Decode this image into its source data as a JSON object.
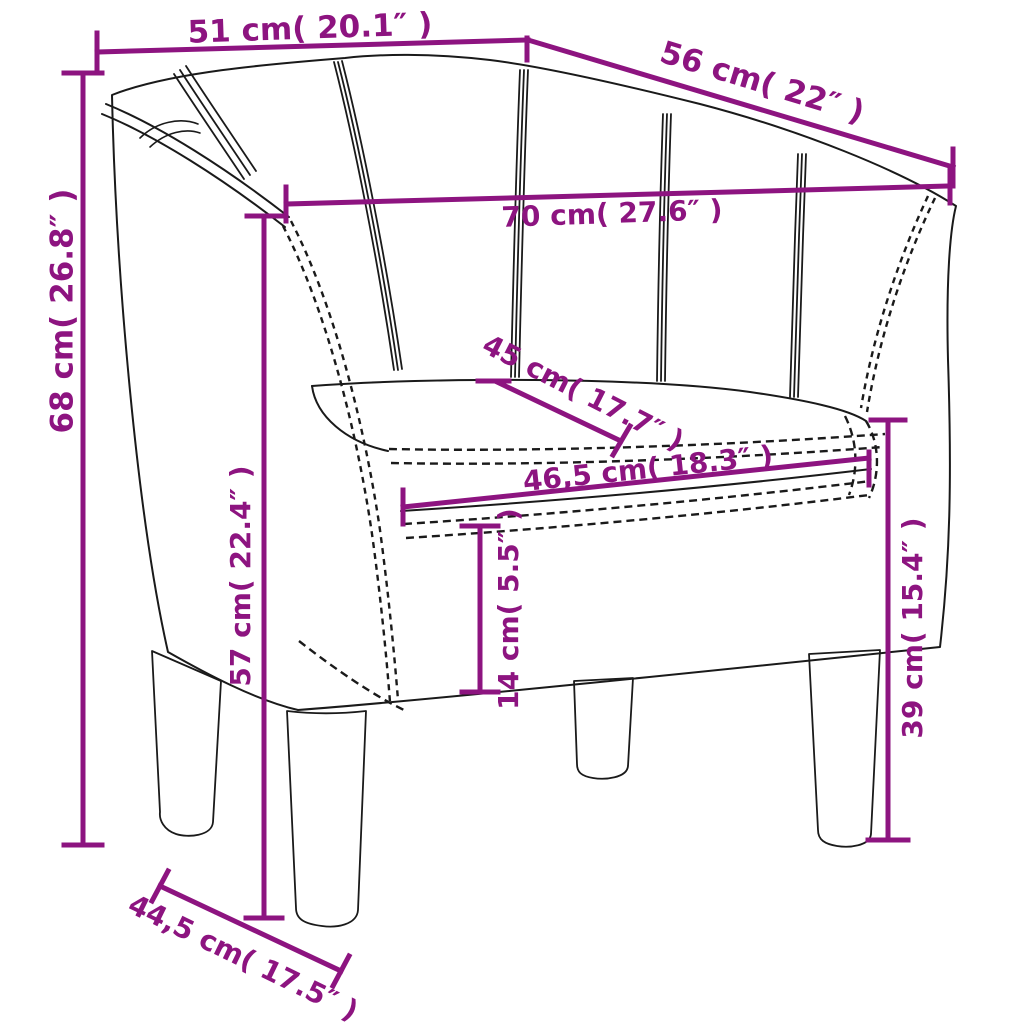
{
  "image": {
    "description": "Line drawing of a tub club armchair with purple measurement annotations",
    "background": "#ffffff"
  },
  "colors": {
    "dimension_accent": "#8D1480",
    "line_art": "#1A1A1A"
  },
  "dimensions": [
    {
      "name": "top-width",
      "label": "51 cm( 20.1″ )"
    },
    {
      "name": "top-depth-diagonal",
      "label": "56 cm( 22″ )"
    },
    {
      "name": "inner-width",
      "label": "70 cm( 27.6″ )"
    },
    {
      "name": "seat-depth-diagonal",
      "label": "45 cm( 17.7″ )"
    },
    {
      "name": "seat-cushion-width",
      "label": "46,5 cm( 18.3″ )"
    },
    {
      "name": "total-height",
      "label": "68 cm( 26.8″ )"
    },
    {
      "name": "armrest-height",
      "label": "57 cm( 22.4″ )"
    },
    {
      "name": "cushion-thickness",
      "label": "14 cm( 5.5″ )"
    },
    {
      "name": "seat-height",
      "label": "39 cm( 15.4″ )"
    },
    {
      "name": "base-depth-diagonal",
      "label": "44,5 cm( 17.5″ )"
    }
  ]
}
